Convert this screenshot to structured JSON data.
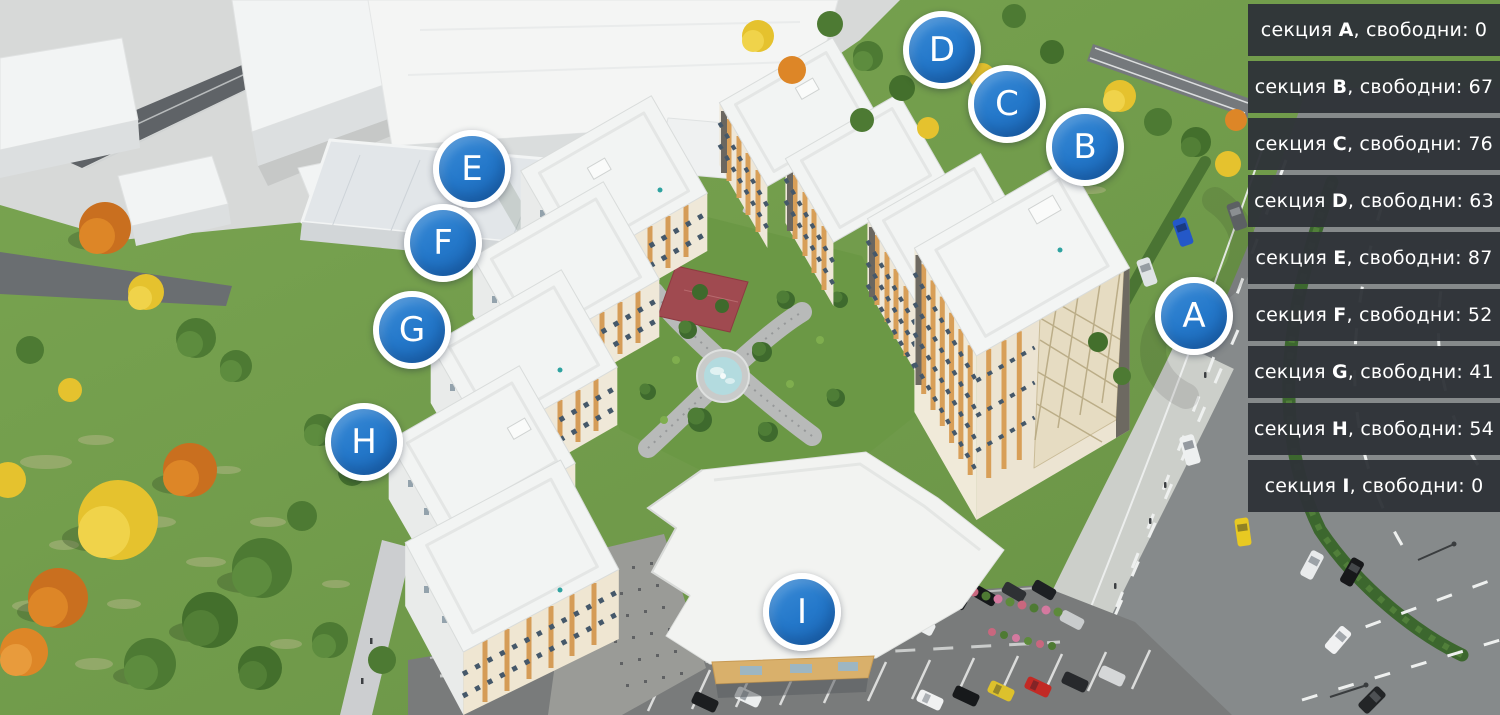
{
  "panel": {
    "prefix": "секция",
    "middle": ", свободни:",
    "items": [
      {
        "letter": "A",
        "available": "0"
      },
      {
        "letter": "B",
        "available": "67"
      },
      {
        "letter": "C",
        "available": "76"
      },
      {
        "letter": "D",
        "available": "63"
      },
      {
        "letter": "E",
        "available": "87"
      },
      {
        "letter": "F",
        "available": "52"
      },
      {
        "letter": "G",
        "available": "41"
      },
      {
        "letter": "H",
        "available": "54"
      },
      {
        "letter": "I",
        "available": "0"
      }
    ]
  },
  "markers": [
    {
      "letter": "D",
      "x": 942,
      "y": 50
    },
    {
      "letter": "C",
      "x": 1007,
      "y": 104
    },
    {
      "letter": "B",
      "x": 1085,
      "y": 147
    },
    {
      "letter": "E",
      "x": 472,
      "y": 169
    },
    {
      "letter": "F",
      "x": 443,
      "y": 243
    },
    {
      "letter": "G",
      "x": 412,
      "y": 330
    },
    {
      "letter": "H",
      "x": 364,
      "y": 442
    },
    {
      "letter": "A",
      "x": 1194,
      "y": 316
    },
    {
      "letter": "I",
      "x": 802,
      "y": 612
    }
  ],
  "colors": {
    "marker_blue": "#2478ca",
    "panel_bg": "rgba(47,51,56,0.96)",
    "panel_text": "#ffffff"
  }
}
